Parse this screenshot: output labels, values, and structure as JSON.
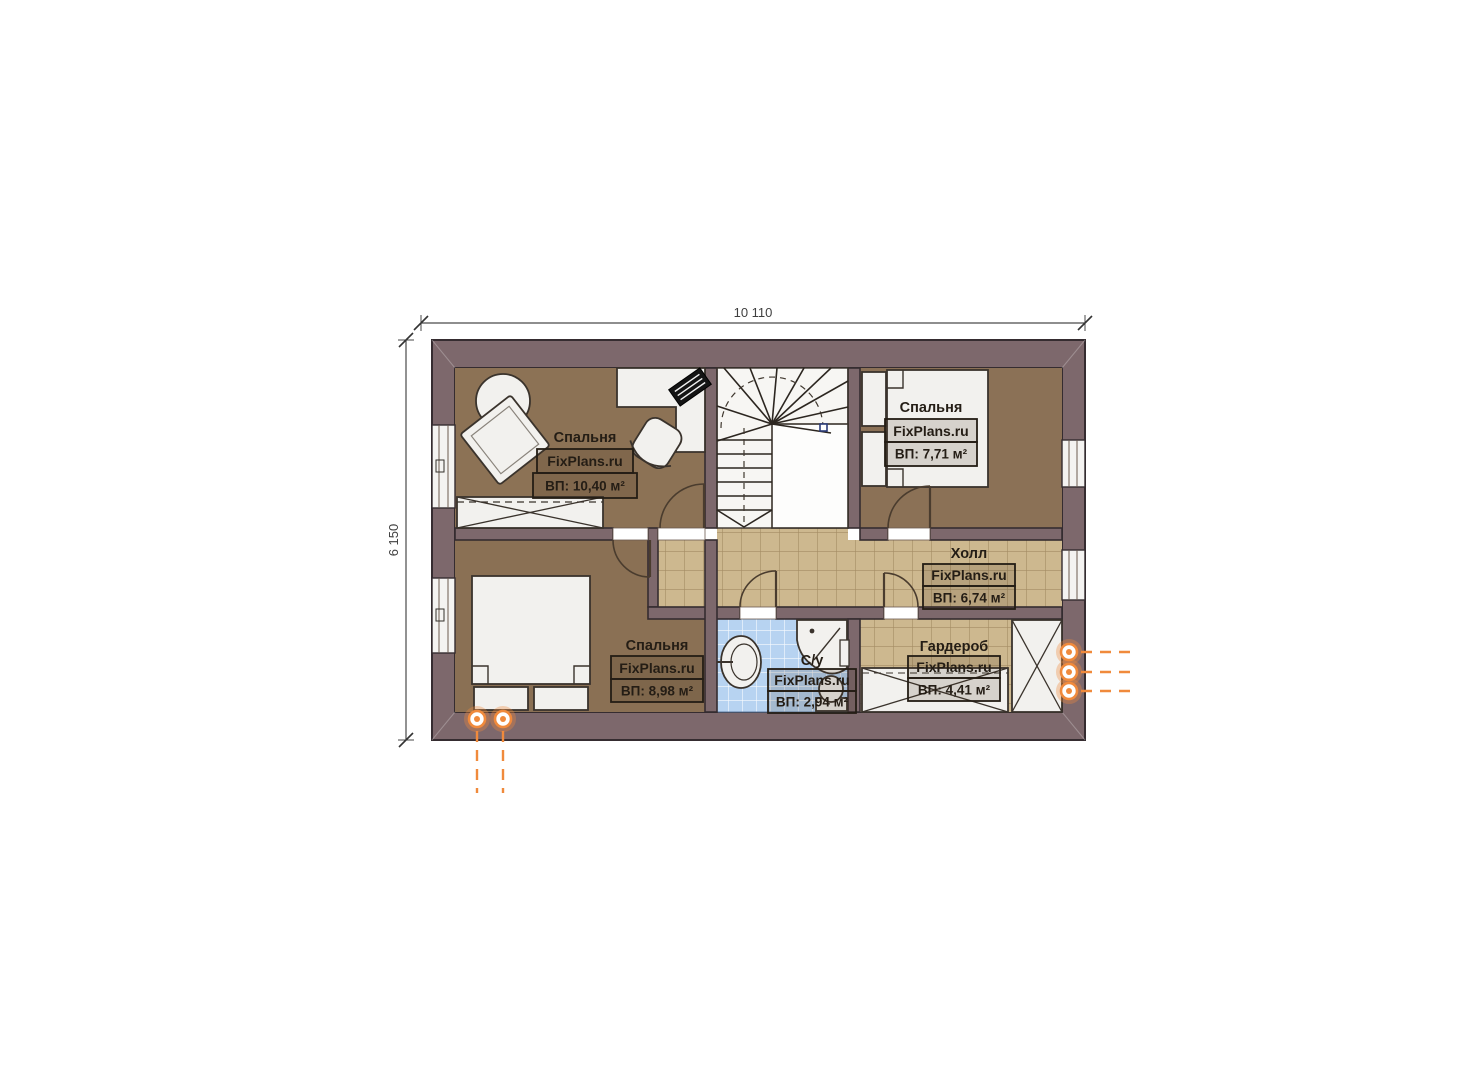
{
  "plan": {
    "title": "attic-floor-plan",
    "dimensions": {
      "width_label": "10 110",
      "height_label": "6 150"
    },
    "watermark": "FixPlans.ru",
    "rooms": [
      {
        "id": "bedroom-top-left",
        "name": "Спальня",
        "area": "ВП: 10,40 м²"
      },
      {
        "id": "bedroom-top-right",
        "name": "Спальня",
        "area": "ВП: 7,71 м²"
      },
      {
        "id": "hall",
        "name": "Холл",
        "area": "ВП: 6,74 м²"
      },
      {
        "id": "bedroom-bottom-left",
        "name": "Спальня",
        "area": "ВП: 8,98 м²"
      },
      {
        "id": "bathroom",
        "name": "С/у",
        "area": "ВП: 2,94 м²"
      },
      {
        "id": "wardrobe",
        "name": "Гардероб",
        "area": "ВП: 4,41 м²"
      }
    ],
    "colors": {
      "wall": "#7d686c",
      "wall_outline": "#352c30",
      "floor_bedroom": "#8c7255",
      "floor_hall_tile": "#cdb88f",
      "floor_bath_tile": "#b7d3f1",
      "stair_floor": "#f7f6f3",
      "furniture": "#f2f1ee",
      "flue_orange": "#f08a3c",
      "background": "#ffffff"
    }
  }
}
